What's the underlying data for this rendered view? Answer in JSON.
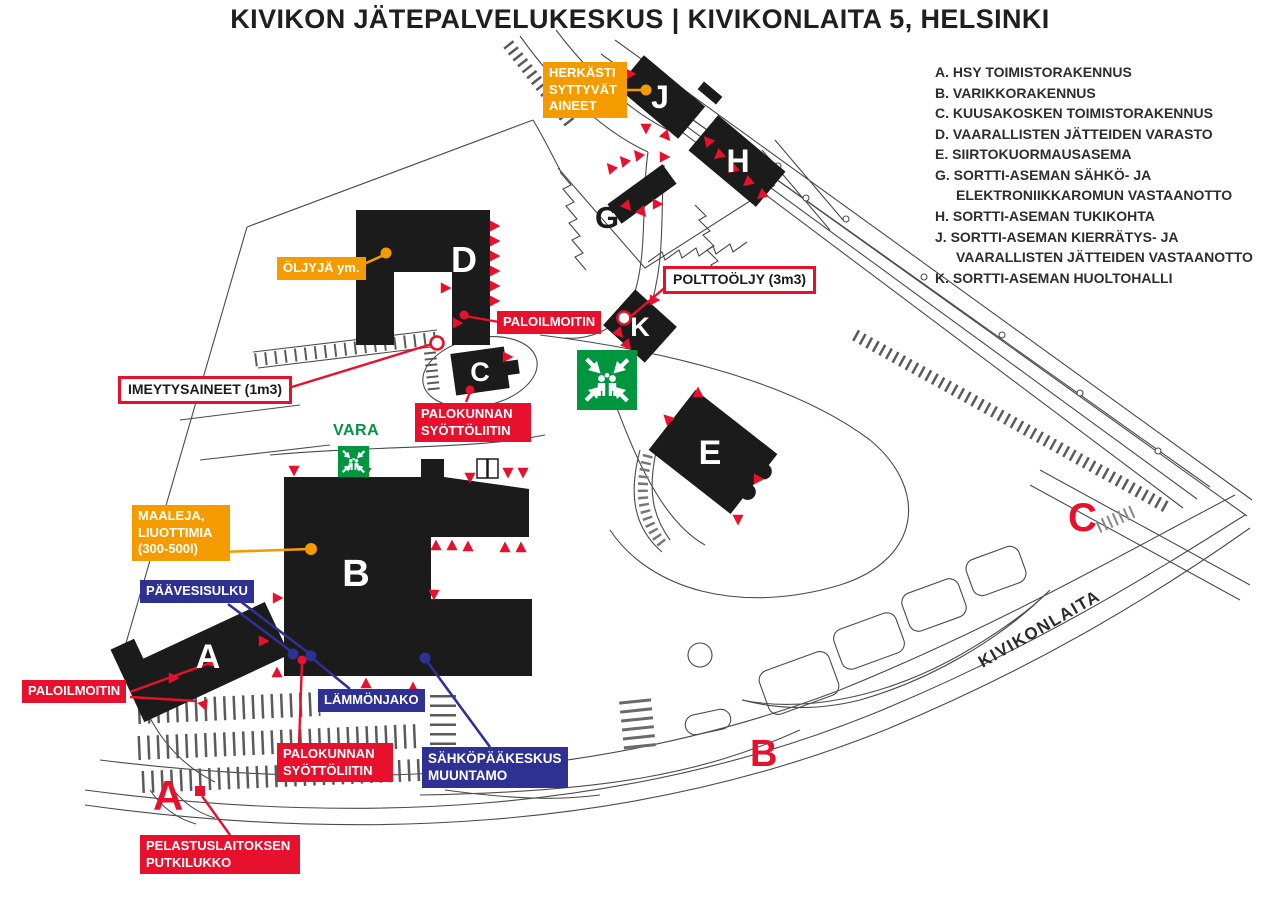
{
  "title": "KIVIKON JÄTEPALVELUKESKUS | KIVIKONLAITA 5, HELSINKI",
  "legend": {
    "items": [
      {
        "label": "A. HSY TOIMISTORAKENNUS"
      },
      {
        "label": "B. VARIKKORAKENNUS"
      },
      {
        "label": "C. KUUSAKOSKEN TOIMISTORAKENNUS"
      },
      {
        "label": "D. VAARALLISTEN JÄTTEIDEN VARASTO"
      },
      {
        "label": "E. SIIRTOKUORMAUSASEMA"
      },
      {
        "label": "G. SORTTI-ASEMAN SÄHKÖ- JA ELEKTRONIIKKAROMUN VASTAANOTTO"
      },
      {
        "label": "H. SORTTI-ASEMAN TUKIKOHTA"
      },
      {
        "label": "J. SORTTI-ASEMAN KIERRÄTYS- JA VAARALLISTEN JÄTTEIDEN VASTAANOTTO"
      },
      {
        "label": "K. SORTTI-ASEMAN HUOLTOHALLI"
      }
    ]
  },
  "annotations": {
    "herkasti": "HERKÄSTI SYTTYVÄT AINEET",
    "oljyja": "ÖLJYJÄ ym.",
    "polttooljy": "POLTTOÖLJY (3m3)",
    "paloilmoitin_d": "PALOILMOITIN",
    "imeytysaineet": "IMEYTYSAINEET (1m3)",
    "palokunnan_c": "PALOKUNNAN SYÖTTÖLIITIN",
    "vara": "VARA",
    "maaleja": "MAALEJA, LIUOTTIMIA (300-500l)",
    "paavesisulku": "PÄÄVESISULKU",
    "paloilmoitin_a": "PALOILMOITIN",
    "lammonjako": "LÄMMÖNJAKO",
    "palokunnan_b": "PALOKUNNAN SYÖTTÖLIITIN",
    "sahkopaakeskus": "SÄHKÖPÄÄKESKUS MUUNTAMO",
    "pelastuslaitoksen": "PELASTUSLAITOKSEN PUTKILUKKO"
  },
  "buildings": {
    "a": "A",
    "b": "B",
    "c": "C",
    "d": "D",
    "e": "E",
    "g": "G",
    "h": "H",
    "j": "J",
    "k": "K"
  },
  "gates": {
    "a": "A",
    "b": "B",
    "c": "C"
  },
  "road_label": "KIVIKONLAITA",
  "colors": {
    "orange": "#F49B00",
    "red": "#E8112D",
    "blue": "#2E3192",
    "green": "#009640",
    "building": "#1B1B1B"
  }
}
